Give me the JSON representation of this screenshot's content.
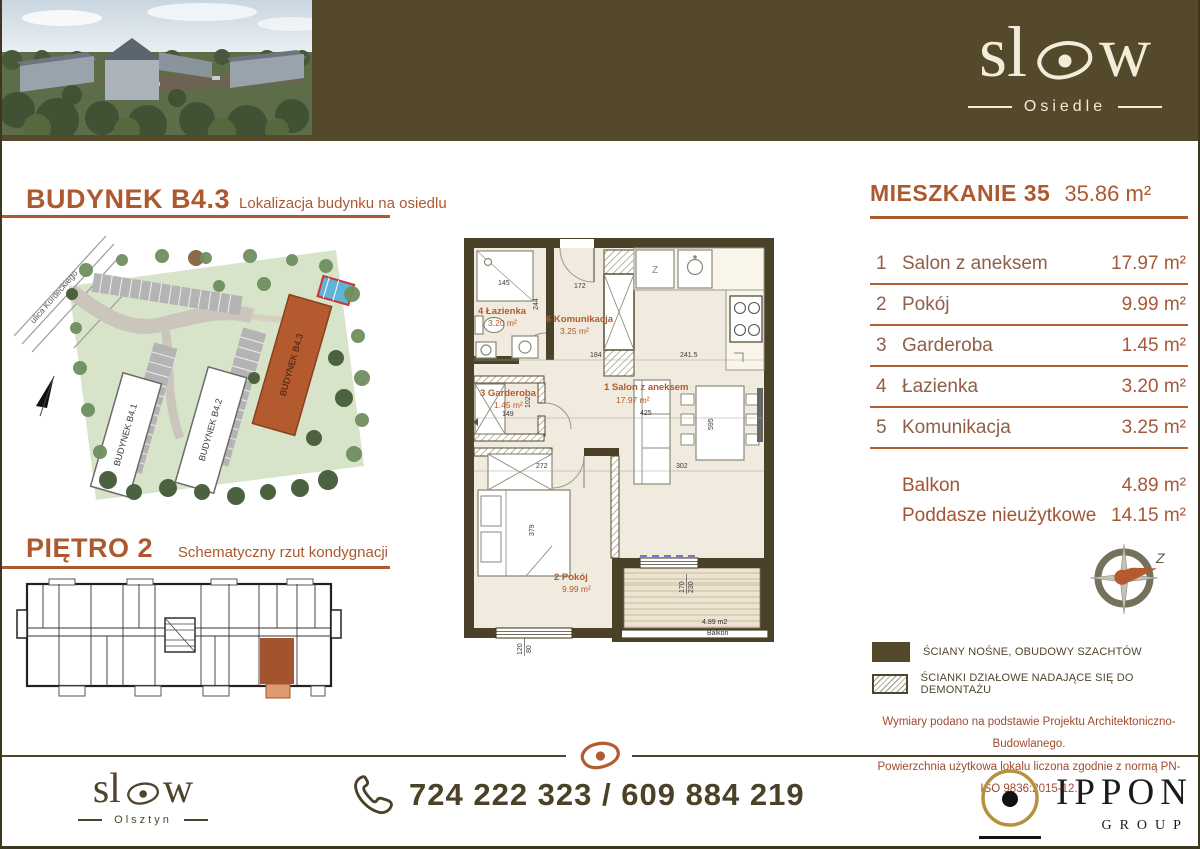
{
  "brand": {
    "logo_prefix": "sl",
    "logo_suffix": "w",
    "logo_sub": "Osiedle",
    "footer_sub": "Olsztyn"
  },
  "left": {
    "section1_title": "BUDYNEK B4.3",
    "section1_subtitle": "Lokalizacja budynku na osiedlu",
    "map_street": "ulica Kordeckiego",
    "map_buildings": [
      "BUDYNEK B4.1",
      "BUDYNEK B4.2",
      "BUDYNEK B4.3"
    ],
    "section2_title": "PIĘTRO 2",
    "section2_subtitle": "Schematyczny rzut kondygnacji"
  },
  "plan": {
    "rooms": [
      {
        "title": "4 Łazienka",
        "area": "3.20 m²"
      },
      {
        "title": "6 Komunikacja",
        "area": "3.25 m²"
      },
      {
        "title": "3 Garderoba",
        "area": "1.45 m²"
      },
      {
        "title": "1 Salon z aneksem",
        "area": "17.97 m²"
      },
      {
        "title": "2 Pokój",
        "area": "9.99 m²"
      }
    ],
    "balcony": {
      "area": "4.89 m2",
      "label": "Balkon"
    },
    "fridge_label": "Z",
    "dims": [
      "145",
      "172",
      "244",
      "184",
      "241.5",
      "102",
      "149",
      "425",
      "595",
      "272",
      "379",
      "302",
      "170",
      "230",
      "120",
      "80"
    ]
  },
  "details": {
    "title": "MIESZKANIE 35",
    "total_area": "35.86 m²",
    "rooms": [
      {
        "no": "1",
        "name": "Salon z aneksem",
        "area": "17.97 m²"
      },
      {
        "no": "2",
        "name": "Pokój",
        "area": "9.99 m²"
      },
      {
        "no": "3",
        "name": "Garderoba",
        "area": "1.45 m²"
      },
      {
        "no": "4",
        "name": "Łazienka",
        "area": "3.20 m²"
      },
      {
        "no": "5",
        "name": "Komunikacja",
        "area": "3.25 m²"
      }
    ],
    "extras": [
      {
        "name": "Balkon",
        "area": "4.89 m²"
      },
      {
        "name": "Poddasze nieużytkowe",
        "area": "14.15 m²"
      }
    ],
    "compass_label": "Z",
    "legend": [
      {
        "type": "solid",
        "label": "ŚCIANY NOŚNE, OBUDOWY SZACHTÓW"
      },
      {
        "type": "hatch",
        "label": "ŚCIANKI DZIAŁOWE NADAJĄCE SIĘ DO DEMONTAŻU"
      }
    ],
    "notes": [
      "Wymiary podano na podstawie Projektu Architektoniczno-Budowlanego.",
      "Powierzchnia użytkowa lokalu liczona zgodnie z normą PN-ISO 9836:2015-12."
    ]
  },
  "footer": {
    "phone": "724 222 323 / 609 884 219",
    "partner_name": "IPPON",
    "partner_sub": "GROUP"
  },
  "colors": {
    "brand_olive": "#54492b",
    "accent_rust": "#ad5930",
    "highlight_unit": "#a3542e"
  }
}
